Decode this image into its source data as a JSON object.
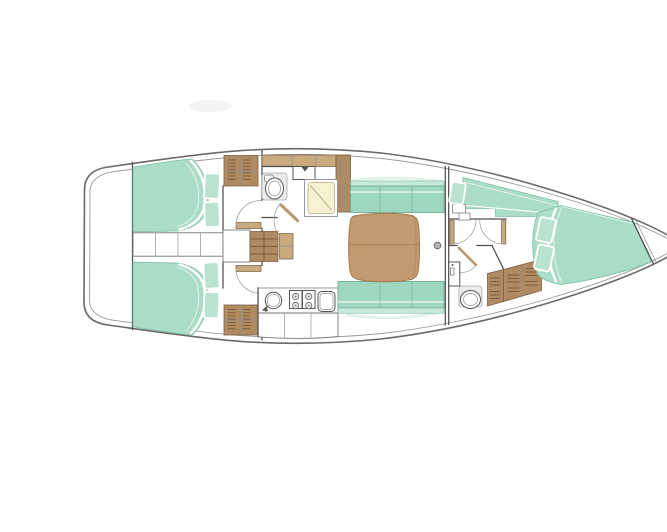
{
  "meta": {
    "label": "sailing-yacht-interior-floor-plan",
    "orientation": "bow-right"
  },
  "colors": {
    "background": "#ffffff",
    "floor_white": "#ffffff",
    "hull_line": "#6a6a6a",
    "inner_hull_line": "#9a9a9a",
    "wall": "#4e4e4e",
    "door_arc": "#a0a0a0",
    "berth_green": "#abdcc7",
    "berth_green_edge": "#7dbfa3",
    "berth_highlight": "#ddf1e8",
    "pillow_green": "#b9e3d0",
    "settee_green": "#9ed7c0",
    "settee_back": "#c6e9da",
    "settee_edge": "#6fae93",
    "wood": "#b08a60",
    "wood_dark": "#7c5f41",
    "wood_light": "#c9a97e",
    "table_wood": "#c39a6f",
    "table_edge": "#a07b50",
    "shower_cream": "#f6f1d2",
    "shower_edge": "#c6bf97",
    "fixture_gray": "#ebebe9",
    "fixture_line": "#909090",
    "mast_gray": "#b9b9b9",
    "shelf_green": "#e2f1e9",
    "smudge": "#f4f4f4"
  },
  "areas": [
    "stern-locker",
    "aft-cabin-port",
    "aft-cabin-starboard",
    "companionway",
    "aft-head",
    "galley",
    "saloon",
    "forward-head",
    "forward-cabin",
    "bow-locker"
  ],
  "inventory": {
    "double_berths": 3,
    "pillows": 6,
    "heads": 2,
    "shower_stalls": 1,
    "stove_burners": 4,
    "sinks": 4,
    "saloon_settees": 2,
    "wardrobes": 2,
    "companionway_steps": 1,
    "mast_posts": 1
  }
}
